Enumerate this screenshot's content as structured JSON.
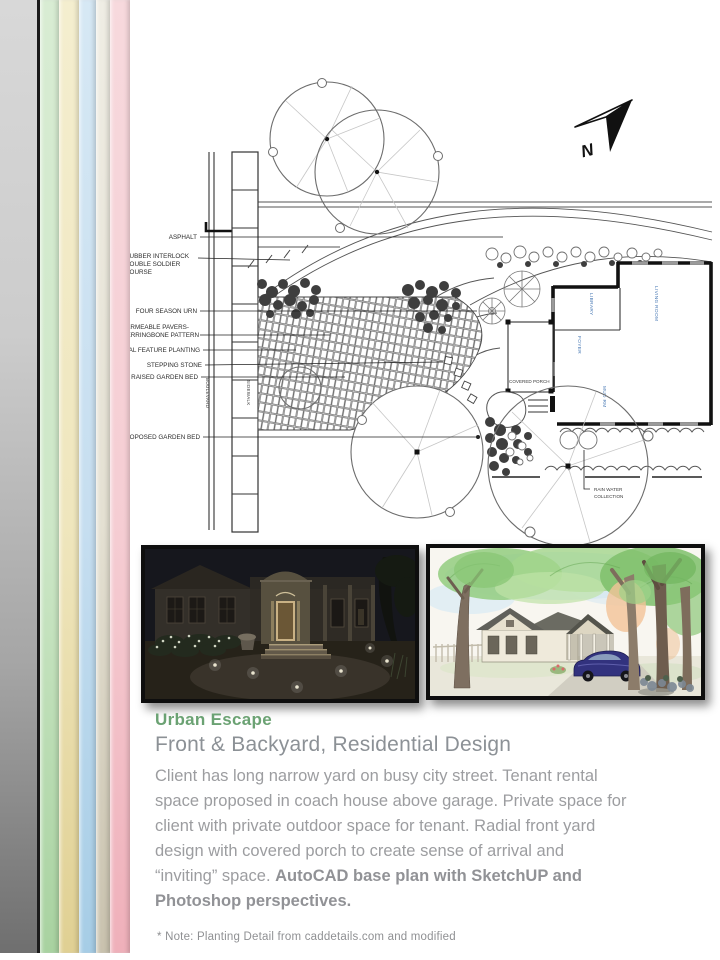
{
  "colors": {
    "accent_green": "#6ba273",
    "subtitle_gray": "#8c9196",
    "body_gray": "#9c9da0",
    "stripe_green": "#a8d2a0",
    "stripe_cream": "#e0d093",
    "stripe_blue": "#a6cde6",
    "stripe_pink": "#efb0ba"
  },
  "plan": {
    "labels": {
      "asphalt": "ASPHALT",
      "rubber_interlock_1": "RUBBER INTERLOCK",
      "rubber_interlock_2": "DOUBLE SOLDIER",
      "rubber_interlock_3": "COURSE",
      "four_season_urn": "FOUR SEASON URN",
      "permeable_pavers_1": "PERMEABLE PAVERS-",
      "permeable_pavers_2": "HERRINGBONE PATTERN",
      "local_feature_planting": "LOCAL FEATURE PLANTING",
      "stepping_stone": "STEPPING STONE",
      "raised_garden_bed": "RAISED GARDEN BED",
      "proposed_garden_bed": "PROPOSED GARDEN BED",
      "rain_water_1": "RAIN WATER",
      "rain_water_2": "COLLECTION",
      "boulevard": "BOULEVARD",
      "sidewalk": "SIDEWALK",
      "covered_porch": "COVERED PORCH",
      "room_library": "LIBRARY",
      "room_living": "LIVING ROOM",
      "room_foyer": "FOYER",
      "room_mudrm": "MUD RM",
      "north": "N"
    }
  },
  "text": {
    "title": "Urban Escape",
    "subtitle": "Front & Backyard, Residential Design",
    "body_regular": "Client has long narrow yard on busy city street. Tenant rental space proposed in coach house above garage. Private space for client with private outdoor space for tenant. Radial front yard design with covered porch to create sense of arrival and “inviting” space. ",
    "body_bold": "AutoCAD base plan with SketchUP and Photoshop perspectives.",
    "note": "* Note: Planting Detail from caddetails.com and modified"
  }
}
